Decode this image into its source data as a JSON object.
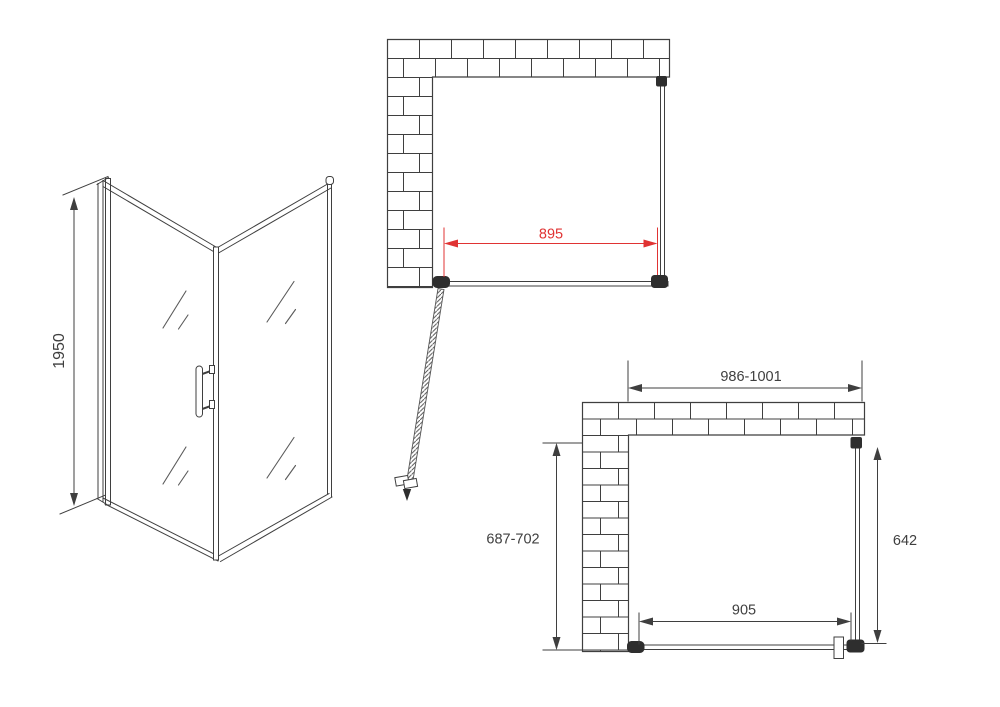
{
  "colors": {
    "line": "#3f3f3f",
    "dark_fittings": "#2e2e2e",
    "dimension_red": "#e03333",
    "brick_fill": "#ffffff",
    "background": "#ffffff"
  },
  "views": {
    "isometric": {
      "height": "1950"
    },
    "plan_door_open": {
      "front_width": "895"
    },
    "plan_overall": {
      "overall_width": "986-1001",
      "depth_range": "687-702",
      "side_panel_depth": "642",
      "front_glass_width": "905"
    }
  }
}
